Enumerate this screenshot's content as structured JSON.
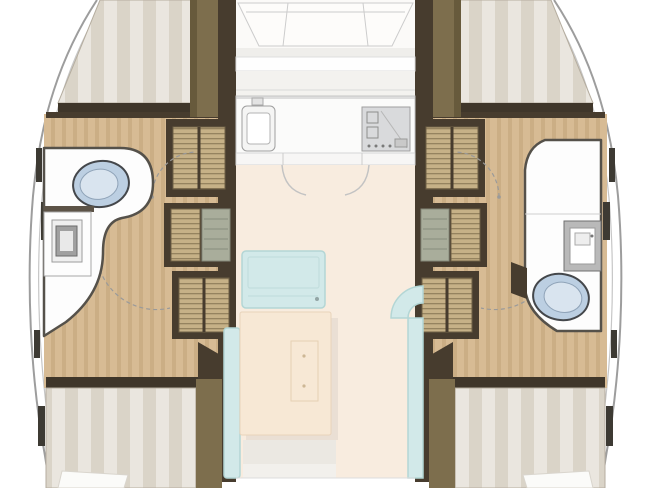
{
  "meta": {
    "kind": "catamaran-floor-plan-top-view"
  },
  "legend": {
    "port-hull": "left hull with forward berth, head and aft berth",
    "starboard-hull": "right hull with forward berth, head and aft berth",
    "forward-berth": "double bed with striped mattress, bow end",
    "aft-berth": "double bed with striped mattress and pillow, stern end",
    "wardrobe": "louvered-door locker",
    "companionway-stairs": "steps from saloon down into hull",
    "head": "bathroom with toilet and sink console",
    "galley": "counter with sink and stove, cabinets under",
    "saloon": "central living area with sofa, benches and dinette table",
    "foredeck": "bow deck panels ahead of the windshield"
  },
  "colors": {
    "wall": "#473c2e",
    "oliveDark": "#675a3c",
    "olive": "#7d6e4d",
    "woodA": "#d7bb94",
    "woodB": "#cbae85",
    "louver": "#c6b187",
    "louverLine": "#95835f",
    "stairsPanel": "#a9ad9b",
    "mattressA": "#eae6df",
    "mattressB": "#dad4c8",
    "bedFrame": "#3f362a",
    "pillow": "#fbfbf9",
    "floorSaloon": "#f8ecdf",
    "deck": "#fbfaf8",
    "deckLine": "#cccccc",
    "counter": "#fbfbfa",
    "counterLine": "#c6c6c6",
    "stove": "#d9dadc",
    "seat": "#d2e9e9",
    "seatLine": "#b3d6d5",
    "table": "#f7e8d5",
    "tableLine": "#e8d3ba",
    "tableShadow": "#eadfd4",
    "stepBand": "#ebe8e2",
    "fixture": "#bccfe2",
    "fixtureLine": "#44474b",
    "bath": "#fdfdfd",
    "bathWall": "#55514a",
    "hullLine": "#9d9d9d",
    "hullInner": "#c6c6c6",
    "arc": "#9a9a9a"
  }
}
